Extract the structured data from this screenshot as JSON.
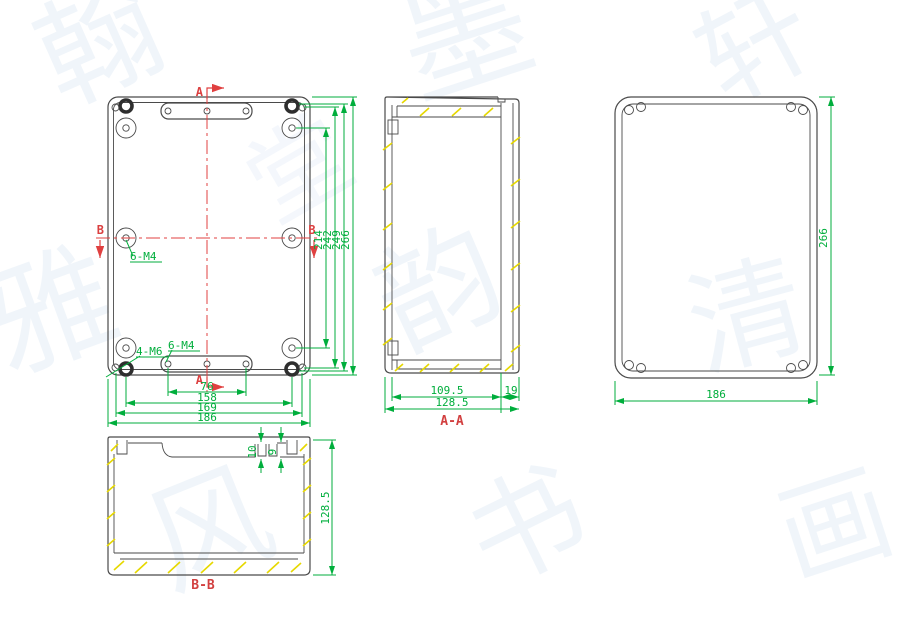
{
  "watermark": {
    "glyphs": [
      "翰",
      "墨",
      "轩",
      "雅",
      "韵",
      "清",
      "风",
      "书",
      "画",
      "堂"
    ]
  },
  "colors": {
    "line": "#4a4a4a",
    "dimension": "#00ae3c",
    "centerline": "#e04040",
    "section_label": "#d24040",
    "hatch": "#e6d800"
  },
  "front_view": {
    "dims_vertical": {
      "boss_span": "214",
      "pilot_span": "242",
      "screw_span": "249",
      "overall_height": "266"
    },
    "dims_horizontal": {
      "tab_holes": "76",
      "screw_span": "158",
      "pilot_span": "169",
      "overall_width": "186"
    },
    "labels": {
      "section_a": "A",
      "section_b": "B",
      "bosses": "6-M4",
      "corner_screws": "4-M6",
      "tab_holes": "6-M4"
    }
  },
  "section_aa": {
    "label": "A-A",
    "dims": {
      "inner_depth": "109.5",
      "lid_depth": "19",
      "overall_depth": "128.5"
    }
  },
  "back_view": {
    "dims": {
      "overall_height": "266",
      "overall_width": "186"
    }
  },
  "section_bb": {
    "label": "B-B",
    "dims": {
      "rim_step": "10",
      "rim_gap": "9",
      "overall_depth": "128.5"
    }
  }
}
